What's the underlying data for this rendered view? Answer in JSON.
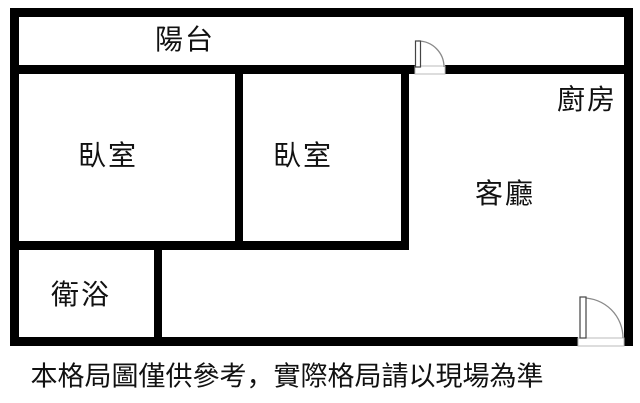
{
  "canvas": {
    "background_color": "#ffffff",
    "wall_color": "#000000",
    "door_line_color": "#8a8a8a",
    "threshold_line_color": "#bbbbbb",
    "text_color": "#111111"
  },
  "rooms": {
    "balcony": {
      "label": "陽台"
    },
    "bedroom1": {
      "label": "臥室"
    },
    "bedroom2": {
      "label": "臥室"
    },
    "kitchen": {
      "label": "廚房"
    },
    "living": {
      "label": "客廳"
    },
    "bathroom": {
      "label": "衛浴"
    }
  },
  "doors": [
    {
      "name": "balcony-door",
      "location": "top wall between living area and balcony"
    },
    {
      "name": "entrance-door",
      "location": "bottom-right exterior wall"
    }
  ],
  "disclaimer": "本格局圖僅供參考，實際格局請以現場為準"
}
